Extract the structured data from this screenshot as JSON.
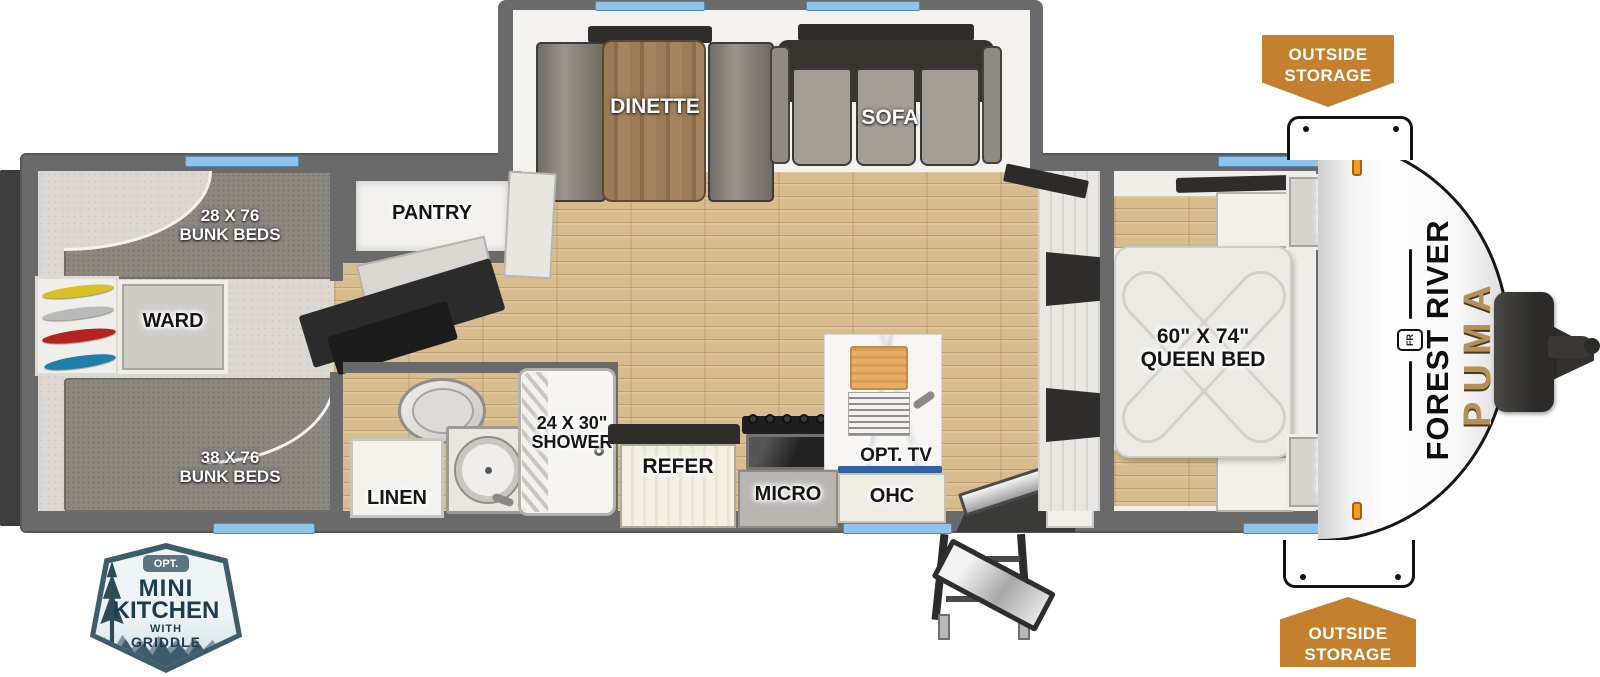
{
  "title": "Forest River Puma travel trailer floorplan",
  "slideout": {
    "dinette_label": "DINETTE",
    "sofa_label": "SOFA"
  },
  "bunk_room": {
    "top_bunk_line1": "28 X 76",
    "top_bunk_line2": "BUNK BEDS",
    "bottom_bunk_line1": "38 X 76",
    "bottom_bunk_line2": "BUNK BEDS",
    "ward_label": "WARD"
  },
  "pantry_label": "PANTRY",
  "bathroom": {
    "linen_label": "LINEN",
    "shower_line1": "24 X 30\"",
    "shower_line2": "SHOWER"
  },
  "kitchen": {
    "refer_label": "REFER",
    "micro_label": "MICRO",
    "ohc_label": "OHC",
    "tv_label": "OPT. TV"
  },
  "bedroom": {
    "bed_line1": "60\" X 74\"",
    "bed_line2": "QUEEN BED",
    "closet_top_label": "CLOSET",
    "closet_bottom_label": "CLOSET"
  },
  "exterior": {
    "outside_storage_top_line1": "OUTSIDE",
    "outside_storage_top_line2": "STORAGE",
    "outside_storage_bottom_line1": "OUTSIDE",
    "outside_storage_bottom_line2": "STORAGE",
    "brand_name": "FOREST RIVER",
    "brand_logo": "FR",
    "model_name": "PUMA"
  },
  "mini_kitchen_badge": {
    "opt": "OPT.",
    "line1": "MINI",
    "line2": "KITCHEN",
    "line3": "WITH",
    "line4": "GRIDDLE"
  },
  "colors": {
    "accent_orange": "#c5802f",
    "window_blue": "#8fc3e9",
    "badge_teal": "#3e5d6b",
    "wall_gray": "#6a6a6a",
    "wood_floor": "#d8bc8e",
    "model_gold": "#b4905a"
  }
}
